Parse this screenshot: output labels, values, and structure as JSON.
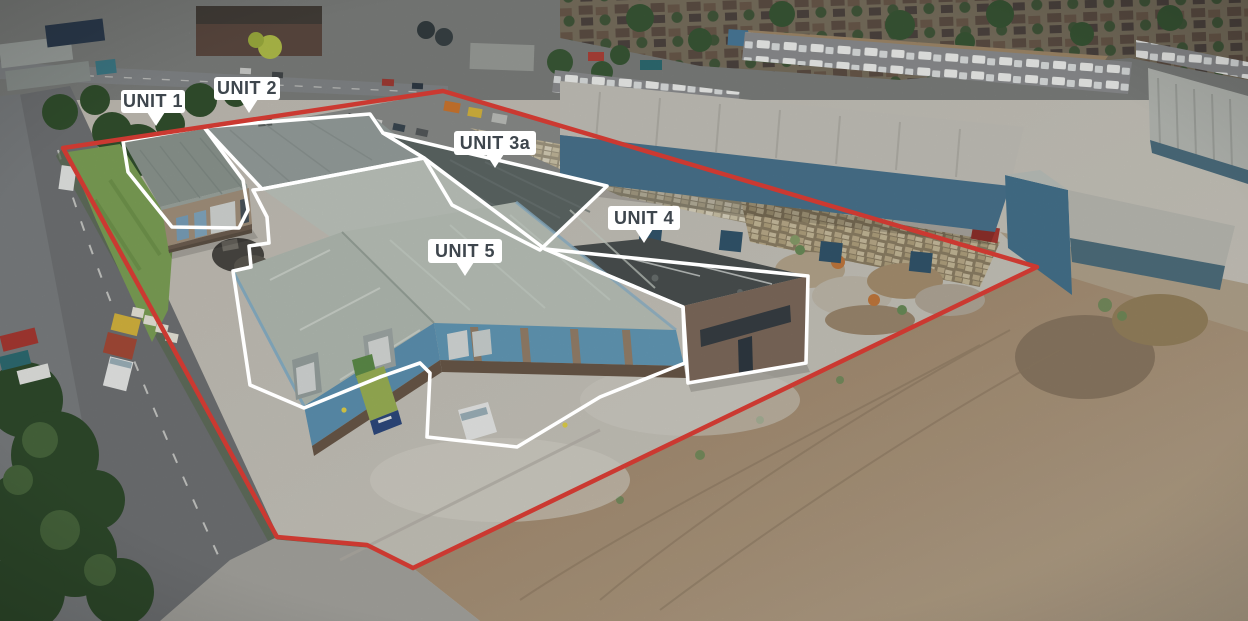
{
  "scene": {
    "type": "aerial-photo",
    "description": "Aerial drone view of an industrial estate with five outlined units, a red site boundary, access road on the left and cleared dirt land to the right"
  },
  "units": [
    {
      "id": "unit-1",
      "label": "UNIT 1"
    },
    {
      "id": "unit-2",
      "label": "UNIT 2"
    },
    {
      "id": "unit-3a",
      "label": "UNIT 3a"
    },
    {
      "id": "unit-4",
      "label": "UNIT 4"
    },
    {
      "id": "unit-5",
      "label": "UNIT 5"
    }
  ],
  "colors": {
    "boundary_red": "#cb3931",
    "unit_outline_white": "#ffffff",
    "label_bg": "#ffffff",
    "label_text": "#3e464d"
  }
}
